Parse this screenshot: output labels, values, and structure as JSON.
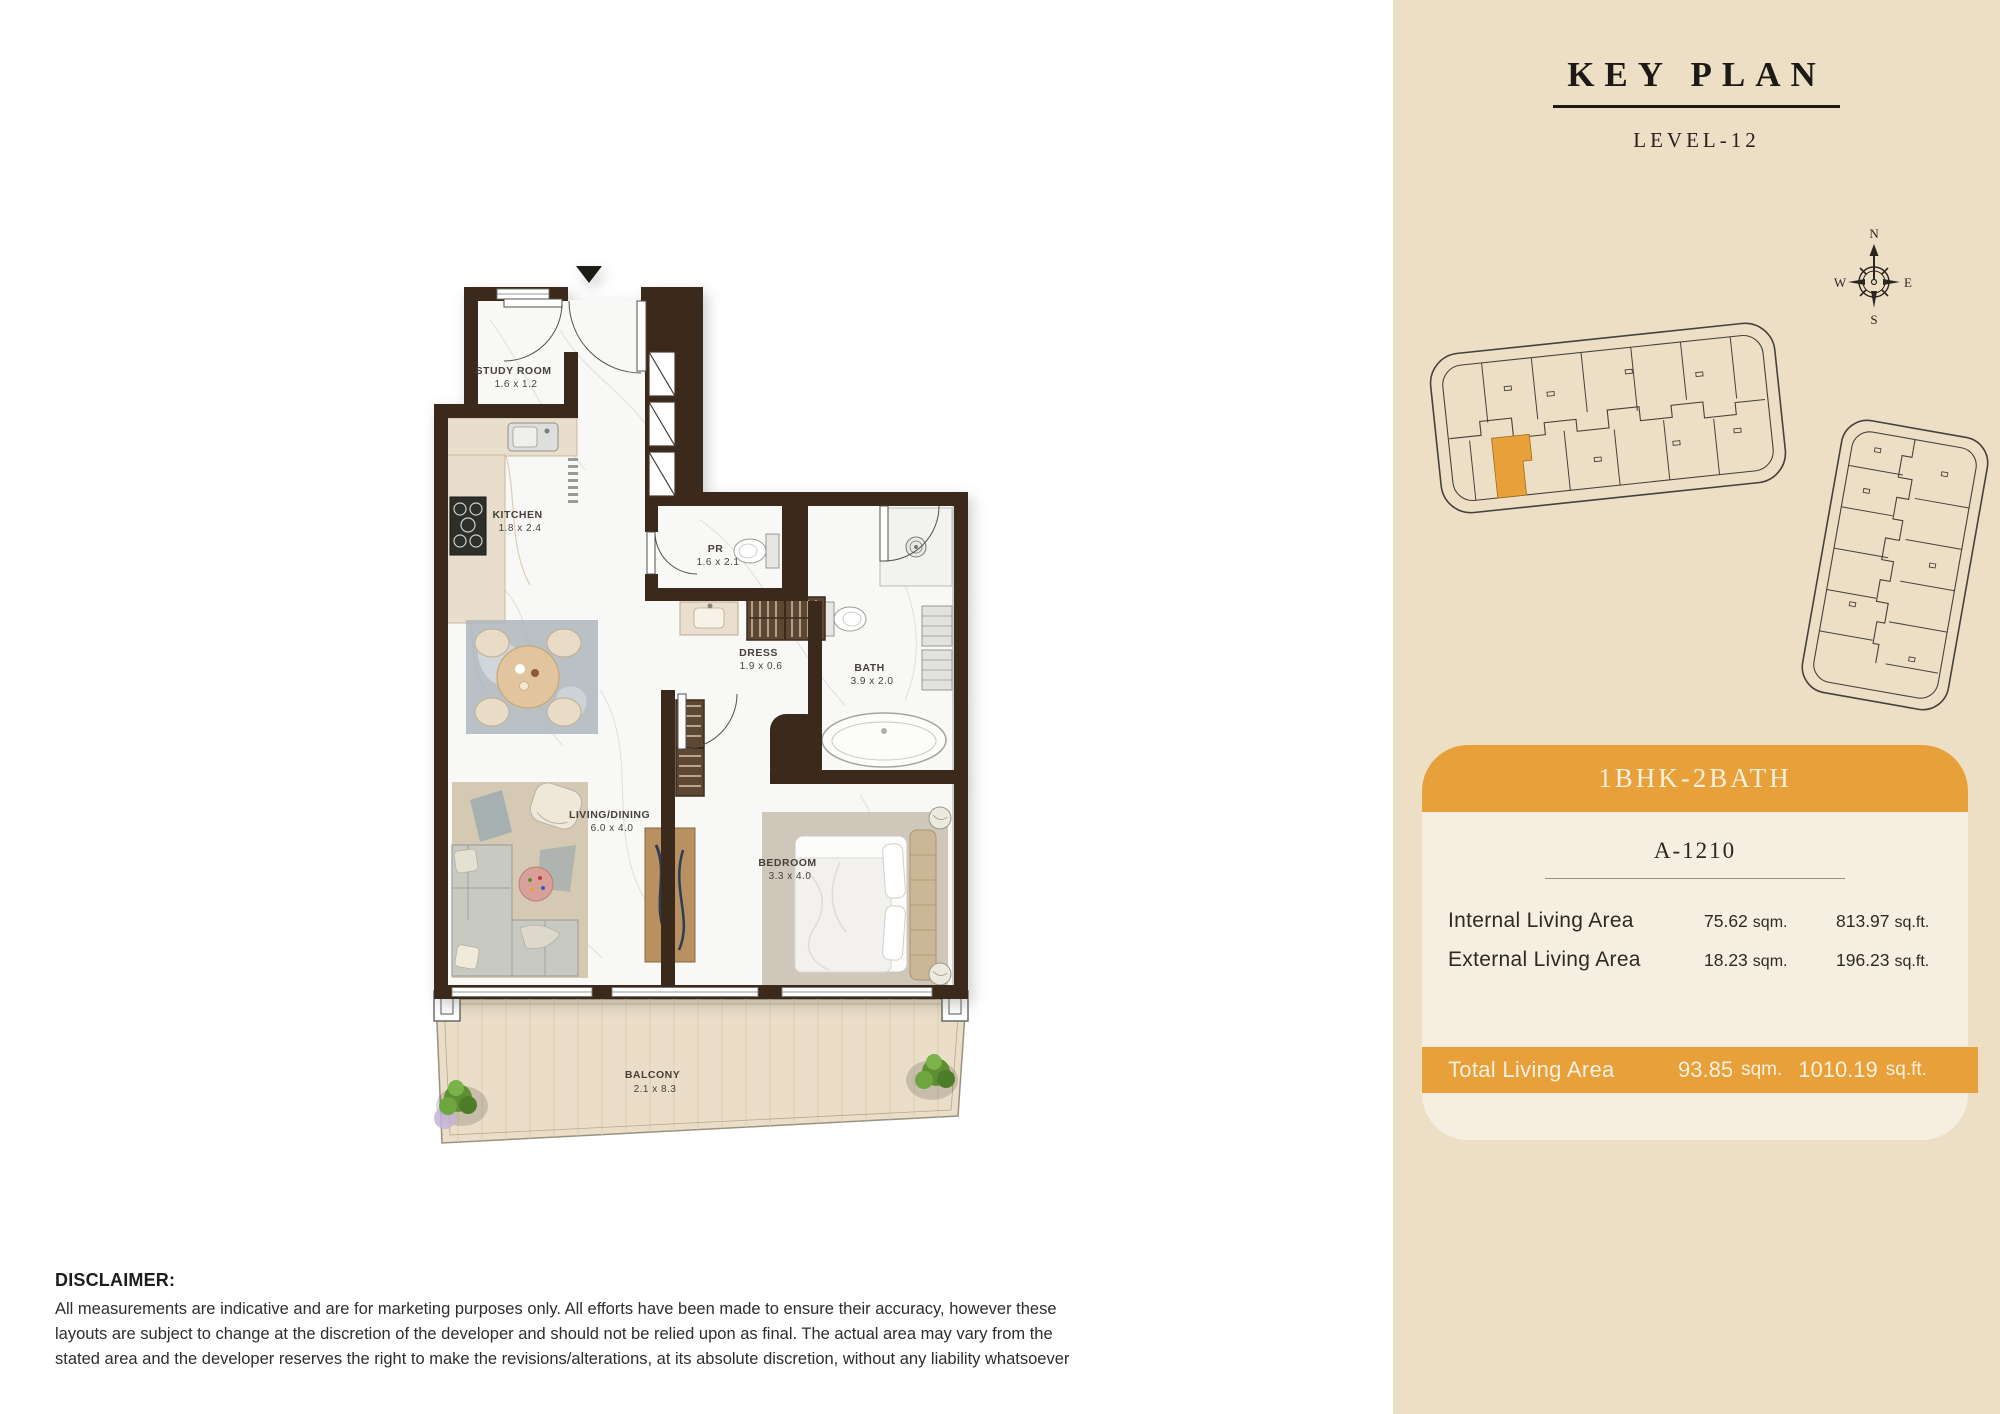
{
  "key_plan": {
    "title": "KEY PLAN",
    "level": "LEVEL-12",
    "compass": {
      "n": "N",
      "s": "S",
      "e": "E",
      "w": "W"
    }
  },
  "unit_card": {
    "type": "1BHK-2BATH",
    "unit_number": "A-1210",
    "rows": [
      {
        "label": "Internal Living Area",
        "sqm": "75.62",
        "sqm_unit": "sqm.",
        "sqft": "813.97",
        "sqft_unit": "sq.ft."
      },
      {
        "label": "External Living Area",
        "sqm": "18.23",
        "sqm_unit": "sqm.",
        "sqft": "196.23",
        "sqft_unit": "sq.ft."
      }
    ],
    "total": {
      "label": "Total Living Area",
      "sqm": "93.85",
      "sqm_unit": "sqm.",
      "sqft": "1010.19",
      "sqft_unit": "sq.ft."
    }
  },
  "floor_plan": {
    "rooms": [
      {
        "name": "STUDY ROOM",
        "dims": "1.6 x 1.2"
      },
      {
        "name": "KITCHEN",
        "dims": "1.8 x 2.4"
      },
      {
        "name": "PR",
        "dims": "1.6 x 2.1"
      },
      {
        "name": "DRESS",
        "dims": "1.9 x 0.6"
      },
      {
        "name": "BATH",
        "dims": "3.9 x 2.0"
      },
      {
        "name": "LIVING/DINING",
        "dims": "6.0 x 4.0"
      },
      {
        "name": "BEDROOM",
        "dims": "3.3 x 4.0"
      },
      {
        "name": "BALCONY",
        "dims": "2.1 x 8.3"
      }
    ]
  },
  "disclaimer": {
    "title": "DISCLAIMER:",
    "body": "All measurements are indicative and are for marketing purposes only. All efforts have been made to ensure their accuracy, however these layouts are subject to change at the discretion of the developer and should not be relied upon as final. The actual area may vary from the stated area and the developer reserves the right to make the revisions/alterations, at its absolute discretion, without any liability whatsoever"
  },
  "colors": {
    "accent_orange": "#E7A03A",
    "panel_beige": "#ECDFC5",
    "card_cream": "#F6EEE0",
    "wall_brown": "#3A2A1C"
  }
}
